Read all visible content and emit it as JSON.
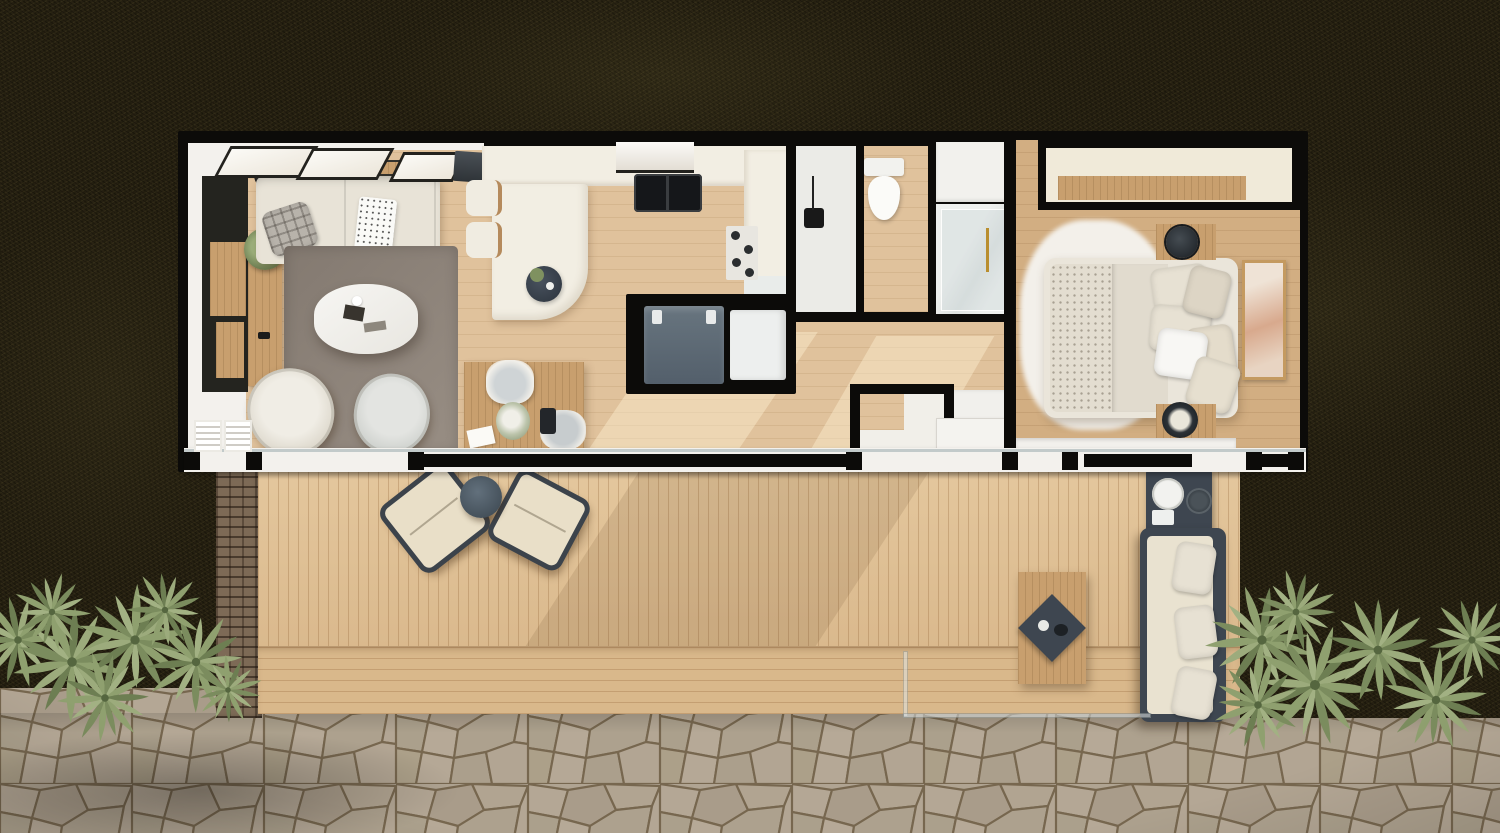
{
  "meta": {
    "description": "Top-down 3D architectural rendering of a rectangular tiny home with a black wall frame, front wood deck, flagstone footpath, palm shrubs and dark lawn",
    "style": "photorealistic floor-plan render, no visible text",
    "view": "plan / bird's-eye"
  },
  "colors": {
    "lawn": "#272112",
    "lawnglow": "#6c6434",
    "stone": "#b0a492",
    "stoneline": "#77674f",
    "brick": "#7d6a56",
    "deck": "#debf95",
    "wall": "#0c0b09",
    "wallwhite": "#f3f1ed",
    "wood": "#e0c29c",
    "woodbed": "#d2ae82",
    "tan": "#c89f6e",
    "rug": "#8d8279",
    "rugbed": "#f3f0ea",
    "cream": "#e8e3d7",
    "counter": "#f2eee3",
    "slate": "#5d6a76",
    "slatedark": "#3e4650",
    "marble": "#e9ecea",
    "green": "#8fa06f",
    "greendark": "#6d7e52",
    "gold": "#b98e2f",
    "art": "#d8a98d"
  },
  "rooms": {
    "living": {
      "label": "living room",
      "items": [
        "sofa",
        "plaid-pillow",
        "dotted-throw",
        "coffee-table",
        "area-rug",
        "swivel-chair-left",
        "swivel-chair-right",
        "media-wall",
        "wood-console",
        "potted-plant",
        "skylights",
        "wall-shelf-speaker"
      ]
    },
    "kitchen": {
      "label": "kitchen",
      "items": [
        "u-counter",
        "island",
        "double-sink",
        "range-hood",
        "cooktop",
        "serving-tray",
        "bar-stools",
        "laptop"
      ]
    },
    "utility": {
      "label": "utility closet",
      "items": [
        "washer",
        "water-heater"
      ]
    },
    "desk": {
      "label": "desk nook",
      "items": [
        "wood-desk",
        "desk-chair",
        "side-chair",
        "flower-bouquet",
        "papers"
      ]
    },
    "bathroom": {
      "label": "bathroom",
      "items": [
        "walk-in-shower",
        "ceiling-shower-head",
        "toilet",
        "vanity-cabinet",
        "marble-shower",
        "glass-door"
      ]
    },
    "hall": {
      "label": "hallway",
      "items": [
        "storage-closet",
        "linen-cabinet",
        "entry-door",
        "sunlight-patches"
      ]
    },
    "bedroom": {
      "label": "bedroom",
      "items": [
        "double-bed",
        "pillows",
        "fluffy-rug",
        "nightstand-top",
        "nightstand-bottom",
        "round-side-tables",
        "wall-art",
        "top-closet",
        "wardrobe-front"
      ]
    }
  },
  "outdoor": {
    "deck": {
      "label": "wood deck",
      "items": [
        "lounge-chair-left",
        "lounge-chair-right",
        "round-side-table",
        "bbq-grill",
        "outdoor-sofa",
        "plank-table",
        "diamond-tray",
        "glass-railing",
        "stone-pillar-wall",
        "step-band"
      ]
    },
    "landscape": {
      "label": "yard",
      "items": [
        "palm-shrubs-left",
        "palm-shrubs-right",
        "flagstone-path",
        "dark-lawn",
        "vignette"
      ]
    }
  }
}
